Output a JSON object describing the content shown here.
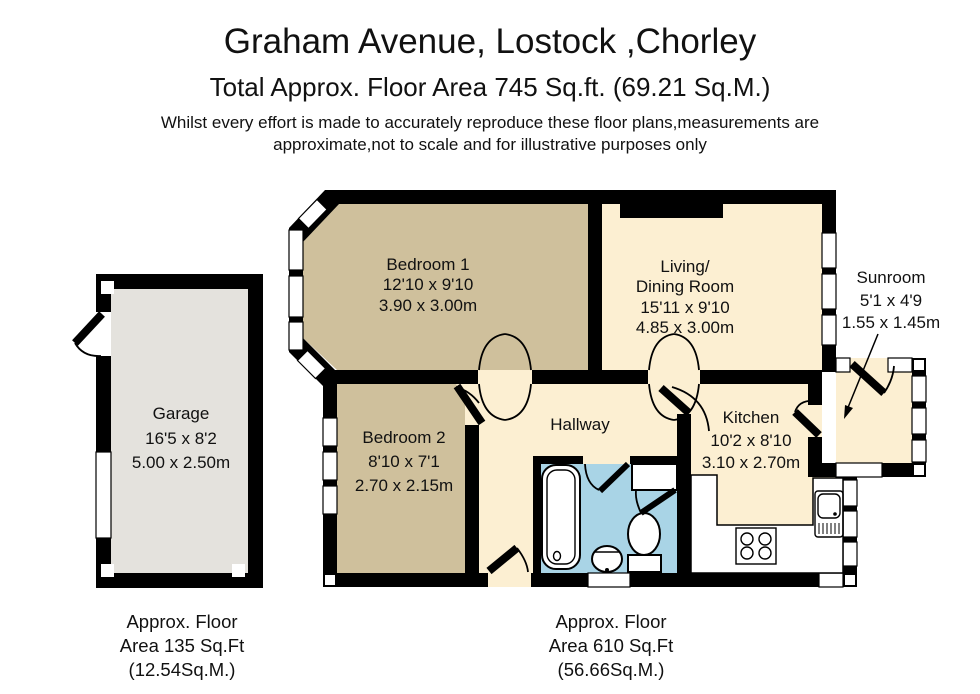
{
  "header": {
    "title": "Graham Avenue, Lostock ,Chorley",
    "subtitle": "Total Approx. Floor Area 745 Sq.ft. (69.21 Sq.M.)",
    "disclaimer1": "Whilst every effort is made to accurately reproduce these floor plans,measurements are",
    "disclaimer2": "approximate,not to scale and for illustrative purposes only"
  },
  "rooms": {
    "garage": {
      "name": "Garage",
      "imperial": "16'5 x 8'2",
      "metric": "5.00 x 2.50m"
    },
    "bedroom1": {
      "name": "Bedroom 1",
      "imperial": "12'10 x 9'10",
      "metric": "3.90 x 3.00m"
    },
    "living": {
      "name": "Living/",
      "name2": "Dining Room",
      "imperial": "15'11 x 9'10",
      "metric": "4.85 x 3.00m"
    },
    "bedroom2": {
      "name": "Bedroom 2",
      "imperial": "8'10 x 7'1",
      "metric": "2.70 x 2.15m"
    },
    "hallway": {
      "name": "Hallway"
    },
    "kitchen": {
      "name": "Kitchen",
      "imperial": "10'2 x 8'10",
      "metric": "3.10 x 2.70m"
    },
    "sunroom": {
      "name": "Sunroom",
      "imperial": "5'1 x 4'9",
      "metric": "1.55 x 1.45m"
    }
  },
  "footnotes": {
    "garage": {
      "line1": "Approx. Floor",
      "line2": "Area 135 Sq.Ft",
      "line3": "(12.54Sq.M.)"
    },
    "main": {
      "line1": "Approx. Floor",
      "line2": "Area 610 Sq.Ft",
      "line3": "(56.66Sq.M.)"
    }
  },
  "colors": {
    "wall": "#000000",
    "bedroom": "#cfc09c",
    "living": "#fcefd2",
    "garage": "#e4e2dd",
    "bathroom": "#a9d4e6",
    "background": "#ffffff"
  }
}
